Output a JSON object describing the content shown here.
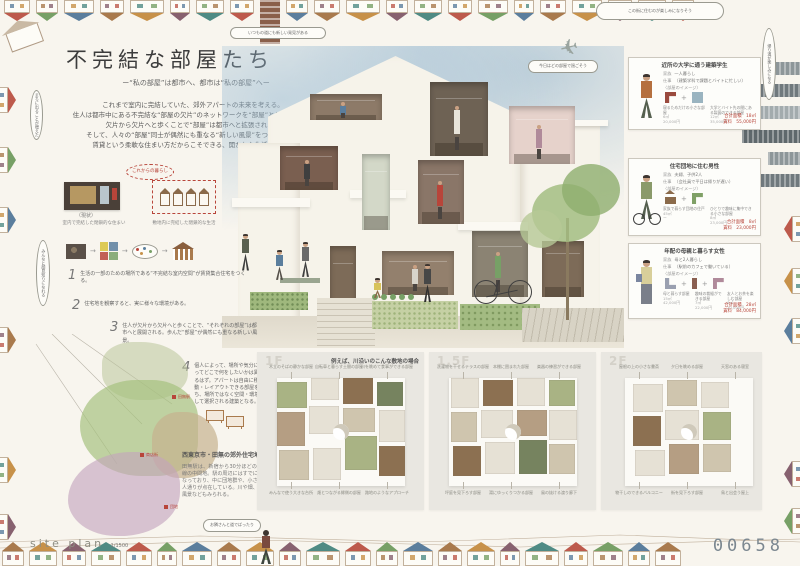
{
  "poster": {
    "title": "不完結な部屋たち",
    "subtitle": "ー“私の部屋”は都市へ、都市は“私の部屋”へー",
    "intro_lines": [
      "これまで室内に完結していた、郊外アパートの未来を考える。",
      "住人は都市中にある不完結な“部屋の欠片”のネットワークを“部屋”として借りる。",
      "欠片から欠片へと歩くことで“部屋”は都市へと拡張される。",
      "そして、人々の“部屋”同士が偶然にも重なる“新しい風景”をつくりだす。",
      "賃貸という柔軟な住まい方だからこそできる、開かれた生活の提案。"
    ],
    "entry_number": "00658"
  },
  "bubbles": {
    "top_right": "この街に住むのが楽しみになりそう",
    "near_plane": "今日はどの部屋で過ごそう",
    "above_house": "いつもの道にも新しい発見がある",
    "bottom_walk": "お隣さんと道でばったり",
    "left_top": "まちに出ることが増えた",
    "left_mid": "みんなと顔見知りになれる",
    "right_side": "帰り道が楽しみになる",
    "stamp": "これからの暮らし"
  },
  "left_column": {
    "current_label": "（現状）",
    "diagram_captions": [
      "室内で完結した閉鎖的な住まい",
      "敷地内に完結した閉鎖的な生活"
    ],
    "steps": [
      {
        "num": "1",
        "text": "生活の一部のための場所である“不完結な室内空間”が賃貸集合住宅をつくる。"
      },
      {
        "num": "2",
        "text": "住宅地を観察すると、実に様々な環境がある。"
      },
      {
        "num": "3",
        "text": "住人が欠片から欠片へと歩くことで、“それぞれの部屋”は都市へと展開される。歩んだ“部屋”が偶然にも重なる新しい風景。"
      },
      {
        "num": "4",
        "text": "個人によって、場所や気分によってどこで何をしたいかは異なるはず。アパートは自由に移動・レイアウトできる部屋を持ち、場所ではなく空間・環境として選択される建築となる。"
      }
    ],
    "area_title": "西東京市・田無の郊外住宅地",
    "area_text": "田無駅は、新宿から30分ほどの西武新宿線の中間地。駅の周辺にはすでに住宅が連なっており、中に団地群や、小さな商店・人通りが点在している。川や畑、緑の多い風景などもみられる。"
  },
  "site": {
    "label": "site plan",
    "scale": "1/1500",
    "markers": [
      "田無駅",
      "商店街",
      "団地"
    ]
  },
  "personas": [
    {
      "title": "近所の大学に通う建築学生",
      "rows": [
        {
          "label": "家族",
          "value": "一人暮らし"
        },
        {
          "label": "仕事",
          "value": "（建築学科で課題とバイトに忙しい）"
        }
      ],
      "image_label": "〈部屋のイメージ〉",
      "pieces": [
        {
          "glyph": "corner",
          "color": "#9a4a3e",
          "caption": "寝るためだけの小さな部屋",
          "area": "6㎡",
          "price": "20,000円"
        },
        {
          "glyph": "rect",
          "color": "#9ab4c0",
          "caption": "大学とバイト先の間にある製図のできる部屋",
          "area": "12㎡",
          "price": "35,000円"
        }
      ],
      "total_area": "合計面積　18㎡",
      "total_rent": "賃料　55,000円"
    },
    {
      "title": "住宅団地に住む男性",
      "rows": [
        {
          "label": "家族",
          "value": "夫婦、子供2人"
        },
        {
          "label": "仕事",
          "value": "（会社員で平日は帰りが遅い）"
        }
      ],
      "image_label": "〈部屋のイメージ〉",
      "pieces": [
        {
          "glyph": "house",
          "color": "#8a6a4a",
          "caption": "家族で暮らす団地の住戸",
          "area": "45㎡",
          "price": "ー"
        },
        {
          "glyph": "corner",
          "color": "#7fa066",
          "caption": "ひとりで趣味に集中できる小さな部屋",
          "area": "8㎡",
          "price": "23,000円"
        }
      ],
      "total_area": "合計面積　8㎡",
      "total_rent": "賃料　23,000円"
    },
    {
      "title": "年配の母親と暮らす女性",
      "rows": [
        {
          "label": "家族",
          "value": "母と2人暮らし"
        },
        {
          "label": "仕事",
          "value": "（駅前のカフェで働いている）"
        }
      ],
      "image_label": "〈部屋のイメージ〉",
      "pieces": [
        {
          "glyph": "L",
          "color": "#9aa0b0",
          "caption": "母と暮らす部屋",
          "area": "15㎡",
          "price": "42,000円"
        },
        {
          "glyph": "bar",
          "color": "#8a5f50",
          "caption": "趣味の裁縫ができる部屋",
          "area": "7㎡",
          "price": "22,000円"
        },
        {
          "glyph": "corner",
          "color": "#b08a9a",
          "caption": "友人とお茶を楽しむ部屋",
          "area": "6㎡",
          "price": "20,000円"
        }
      ],
      "total_area": "合計面積　28㎡",
      "total_rent": "賃料　84,000円"
    }
  ],
  "plans": [
    {
      "label": "1F",
      "caption": "例えば、川沿いのこんな敷地の場合",
      "notes": [
        "木立のそばの静かな部屋",
        "自転車と暮らす土間の部屋",
        "川を眺めて食事ができる部屋",
        "みんなで使う大きな台所",
        "畑とつながる縁側の部屋",
        "路地のようなアプローチ"
      ]
    },
    {
      "label": "1.5F",
      "caption": "",
      "notes": [
        "洗濯物を干せるテラスの部屋",
        "本棚に囲まれた部屋",
        "楽器の練習ができる部屋",
        "坪庭を見下ろす部屋",
        "湯にゆっくりつかる部屋",
        "風の抜ける渡り廊下"
      ]
    },
    {
      "label": "2F",
      "caption": "",
      "notes": [
        "屋根の上の小さな書斎",
        "夕日を眺める部屋",
        "天窓のある寝室",
        "物干しのできるバルコニー",
        "街を見下ろす部屋",
        "鳥と出会う屋上"
      ]
    }
  ],
  "colors": {
    "paper": "#f8f5ee",
    "ink": "#4a4a4a",
    "red": "#b8453a",
    "sky": "#c3d7e2",
    "wall": "#f6f3ea",
    "number": "#7b8790",
    "roofPalette": [
      "#bd5a4c",
      "#77a066",
      "#5b7e9d",
      "#a97a4d",
      "#c79149",
      "#87616f",
      "#4f8b84"
    ],
    "towerPalette": [
      "#8d9699",
      "#70797d",
      "#a3abad",
      "#5f686c"
    ],
    "roomPalette": [
      "#8d7a68",
      "#6e6254",
      "#e6d2cb",
      "#7a5f50",
      "#d3d8c8",
      "#8a7668",
      "#93806d",
      "#8b8373",
      "#7d6b58"
    ],
    "planRoomPalette": [
      "#a9b384",
      "#8c7051",
      "#cfc5ae",
      "#e6e1d5",
      "#76835f",
      "#b59e83"
    ]
  }
}
